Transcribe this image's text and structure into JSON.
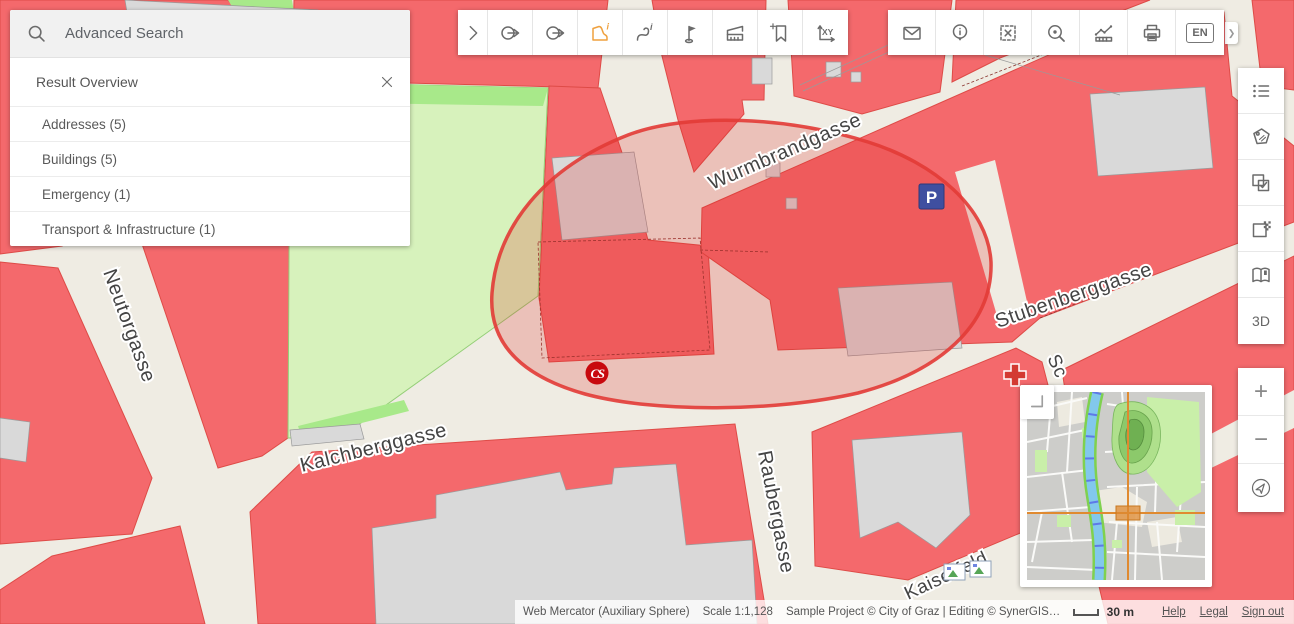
{
  "search_panel": {
    "placeholder": "Advanced Search",
    "title": "Result Overview",
    "close_icon": "close",
    "results": [
      {
        "label": "Addresses (5)"
      },
      {
        "label": "Buildings (5)"
      },
      {
        "label": "Emergency (1)"
      },
      {
        "label": "Transport & Infrastructure (1)"
      }
    ]
  },
  "toolbar_main": {
    "buttons": [
      {
        "name": "expand-toolbar-icon"
      },
      {
        "name": "select-circle-remove-icon"
      },
      {
        "name": "select-circle-icon"
      },
      {
        "name": "identify-polygon-icon",
        "active": true
      },
      {
        "name": "identify-line-icon"
      },
      {
        "name": "flag-marker-icon"
      },
      {
        "name": "measure-dimension-icon"
      },
      {
        "name": "add-bookmark-icon"
      },
      {
        "name": "coordinates-xy-icon"
      }
    ]
  },
  "toolbar_secondary": {
    "buttons": [
      {
        "name": "mail-icon"
      },
      {
        "name": "info-point-icon"
      },
      {
        "name": "clear-selection-icon"
      },
      {
        "name": "zoom-point-icon"
      },
      {
        "name": "measure-profile-icon"
      },
      {
        "name": "print-icon"
      },
      {
        "name": "language-button",
        "label": "EN"
      }
    ]
  },
  "sidebar": {
    "buttons": [
      {
        "name": "legend-icon"
      },
      {
        "name": "labels-tag-icon"
      },
      {
        "name": "select-layers-icon"
      },
      {
        "name": "transparency-icon"
      },
      {
        "name": "map-book-icon"
      },
      {
        "name": "view-3d-button",
        "label": "3D"
      }
    ],
    "zoom": {
      "zoom_in": "+",
      "zoom_out": "−"
    }
  },
  "map": {
    "street_labels": [
      {
        "text": "Wurmbrandgasse"
      },
      {
        "text": "Stubenberggasse"
      },
      {
        "text": "Neutorgasse"
      },
      {
        "text": "Kalchberggasse"
      },
      {
        "text": "Raubergasse"
      },
      {
        "text": "Kaiserfeld"
      },
      {
        "text": "Sc"
      }
    ],
    "markers": {
      "parking": "P",
      "car_sharing": "CS"
    },
    "colors": {
      "building": "#F4696C",
      "street": "#EFECE3",
      "park": "#D7F2BC",
      "selection_stroke": "#E23B36",
      "parking_blue": "#3F4FA0",
      "minimap_crosshair": "#E08A30"
    }
  },
  "statusbar": {
    "projection": "Web Mercator (Auxiliary Sphere)",
    "scale": "Scale 1:1,128",
    "copyright": "Sample Project © City of Graz | Editing © SynerGIS…",
    "scalebar_label": "30 m",
    "links": [
      {
        "label": "Help"
      },
      {
        "label": "Legal"
      },
      {
        "label": "Sign out"
      }
    ]
  }
}
